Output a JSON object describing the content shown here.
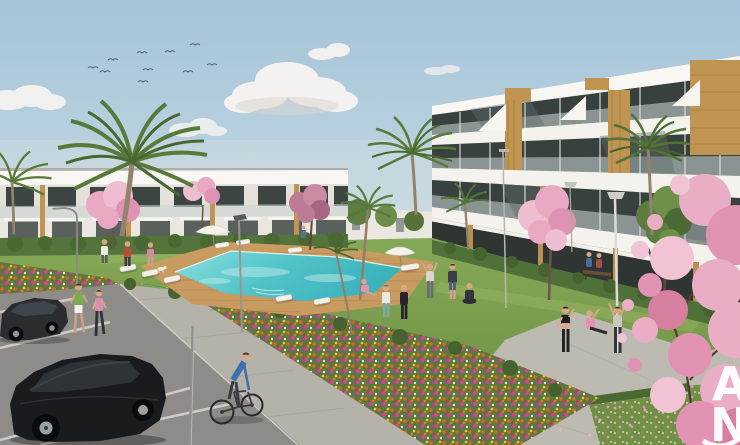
{
  "image": {
    "description": "Architectural render of a new-build apartment complex: communal turquoise pool with wooden deck and white sun loungers, lawns and flower beds, palm trees and pink cherry-blossom trees, residents jogging, cycling and exercising, parking lot with two dark cars",
    "watermark": {
      "letter_top": "A",
      "letter_bottom": "N",
      "color": "#ffffff"
    }
  },
  "palette": {
    "sky_top": "#a4c3d8",
    "sky_horizon": "#e2e9e6",
    "building_white": "#f4f2ec",
    "glass_dark": "#39413e",
    "wood_accent": "#c09552",
    "grass": "#7da053",
    "hedge": "#4f7038",
    "pool_water": "#57c8cc",
    "pool_deck": "#c89b61",
    "path_concrete": "#b5b2a9",
    "asphalt": "#8d8c88",
    "parking_line": "#d6d4cc",
    "blossom_pink": "#e8a8c2",
    "flower_orange": "#d96a2a",
    "flower_magenta": "#c74f86",
    "flower_purple": "#9a4a9a",
    "car_black": "#17181b",
    "skin": "#d8a886"
  },
  "inventory": {
    "birds": 10,
    "clouds": 5,
    "cars": 2,
    "cyclists": 1,
    "joggers": 2,
    "people_total": 18,
    "sun_loungers": 9,
    "parasols": 2,
    "lamp_posts": 6,
    "palm_trees": 7,
    "blossom_trees": 5,
    "pools": 1,
    "benches": 2
  }
}
